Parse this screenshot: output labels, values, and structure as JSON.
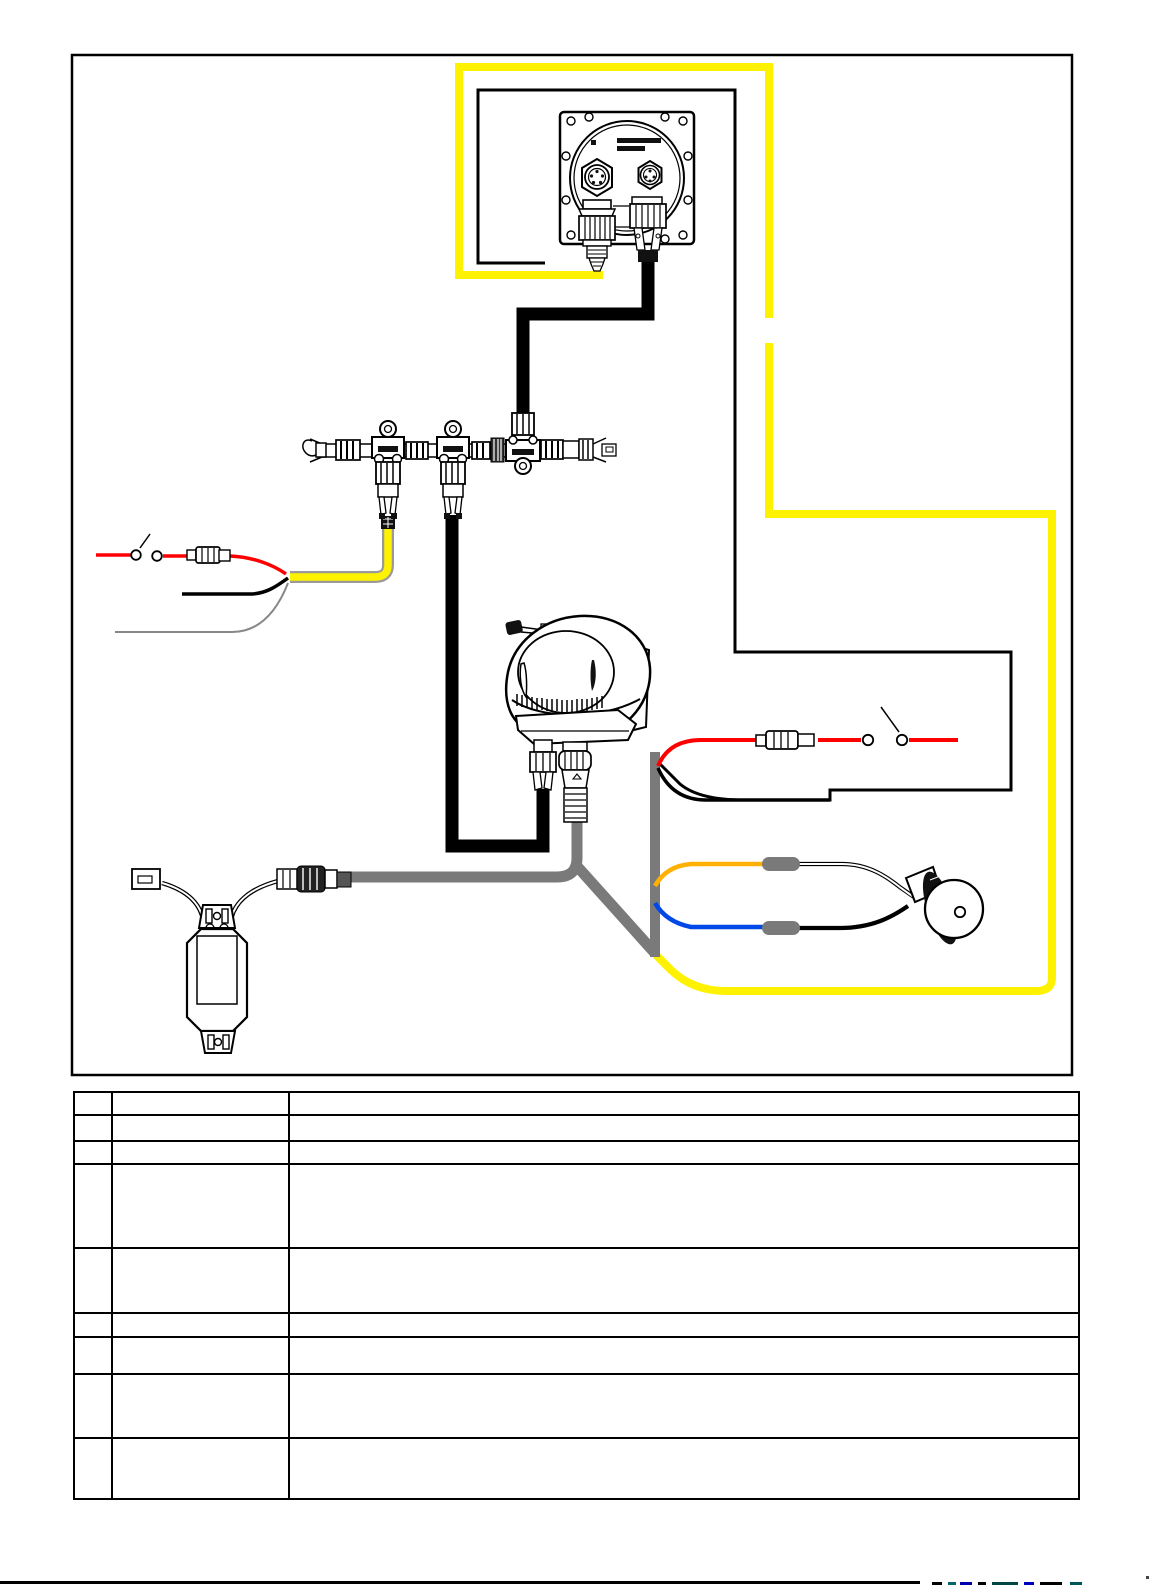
{
  "page": {
    "background": "#ffffff",
    "title": ""
  },
  "colors": {
    "yellow": "#FFF200",
    "red": "#FF0000",
    "orange": "#FFB000",
    "blue": "#0048E8",
    "gray": "#7a7a7a",
    "gray_light": "#9a9a9a",
    "black": "#000000",
    "white": "#ffffff"
  },
  "diagram": {
    "type": "wiring-diagram",
    "components": [
      "nmea2000-display-gauge-rear",
      "gauge-power-plug",
      "gauge-signal-plug",
      "nmea2000-backbone-terminator-left",
      "nmea2000-tee-connector-1",
      "nmea2000-tee-connector-2",
      "nmea2000-tee-connector-3-inverted",
      "nmea2000-backbone-terminator-right",
      "drop-cable-black",
      "power-cable-yellow",
      "inline-fuse-left",
      "power-switch-left",
      "inline-fuse-right",
      "power-switch-right",
      "pump-motor-unit",
      "control-module",
      "module-breakout-connector",
      "round-cable-connector",
      "butt-splice-orange",
      "butt-splice-blue",
      "buzzer"
    ]
  },
  "table": {
    "rows": [
      {
        "num": "",
        "name": "",
        "desc": ""
      },
      {
        "num": "",
        "name": "",
        "desc": ""
      },
      {
        "num": "",
        "name": "",
        "desc": ""
      },
      {
        "num": "",
        "name": "",
        "desc": ""
      },
      {
        "num": "",
        "name": "",
        "desc": ""
      },
      {
        "num": "",
        "name": "",
        "desc": ""
      },
      {
        "num": "",
        "name": "",
        "desc": ""
      },
      {
        "num": "",
        "name": "",
        "desc": ""
      },
      {
        "num": "",
        "name": "",
        "desc": ""
      }
    ]
  },
  "footer": {
    "text": ""
  }
}
